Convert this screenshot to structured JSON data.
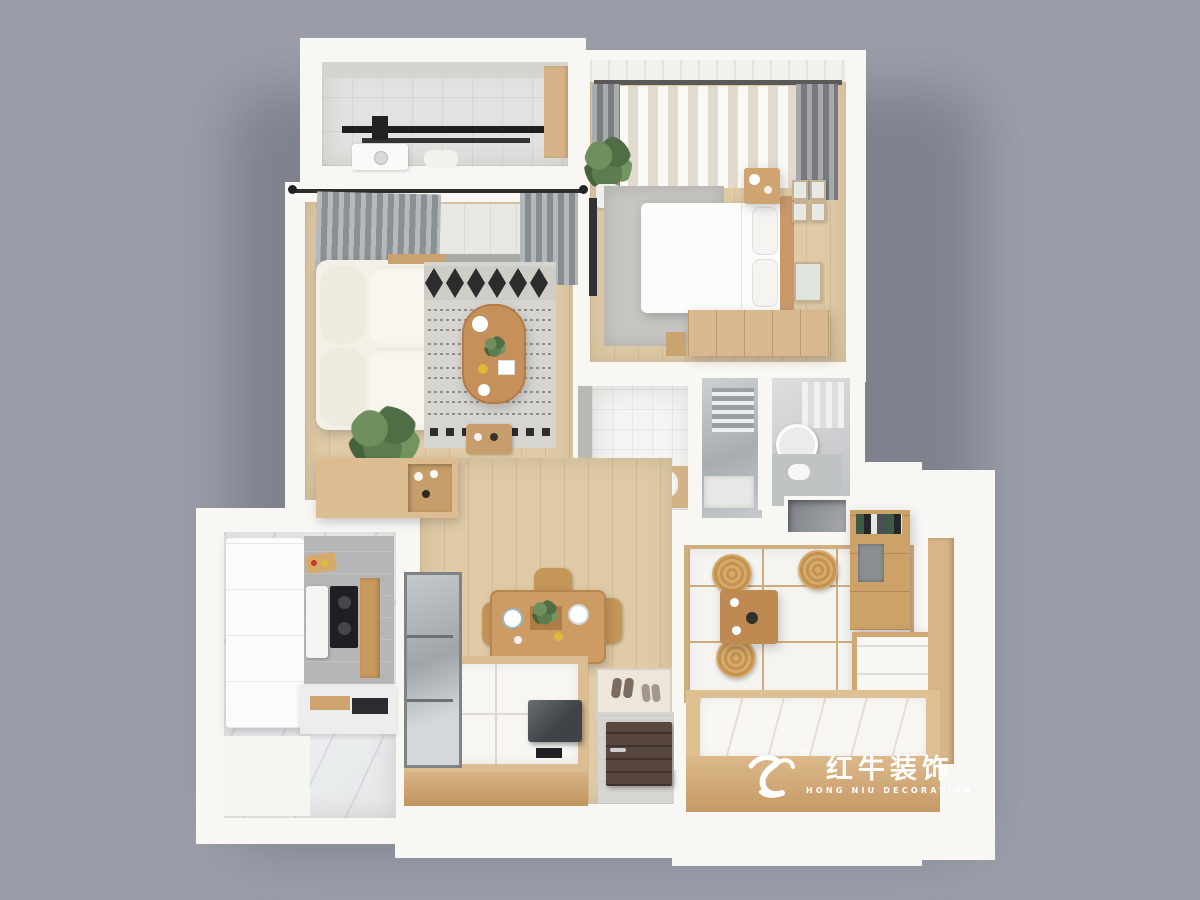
{
  "scene": {
    "type": "3d-floorplan-top-view-render",
    "background_color": "#9b9ea9",
    "palette": {
      "wall_white": "#f8f7f4",
      "wood_light": "#dcbc90",
      "wood_mid": "#c89b62",
      "floor_wood": "#e0cba6",
      "marble": "#eef0f1",
      "tile_gray": "#e2e3e0",
      "glass_gray": "#b9bec1",
      "door_dark": "#57473e",
      "accent_black": "#232323",
      "rattan": "#c2924f",
      "rug_gray": "#c8c6c1"
    },
    "rooms": [
      {
        "name": "balcony-laundry",
        "furniture": [
          "drying-rack",
          "washing-machine",
          "storage-cabinet"
        ]
      },
      {
        "name": "master-bedroom",
        "furniture": [
          "double-bed",
          "pillows",
          "headboard",
          "nightstand",
          "wardrobe",
          "rug",
          "sheer-curtain",
          "drape-curtains",
          "plant",
          "wall-frames",
          "wall-tv"
        ]
      },
      {
        "name": "living-room",
        "furniture": [
          "sofa",
          "coffee-table",
          "patterned-rug",
          "gray-curtains",
          "monstera-plant",
          "gallery-frames",
          "sideboard",
          "side-table"
        ]
      },
      {
        "name": "bathroom-suite",
        "furniture": [
          "bathtub",
          "shower-room",
          "towel-radiator",
          "round-mirror",
          "vanity-sink",
          "storage-niche"
        ]
      },
      {
        "name": "kitchen",
        "furniture": [
          "white-cabinets",
          "cooktop",
          "backsplash",
          "boiler",
          "tall-wood-cabinet",
          "counter",
          "cutting-board"
        ]
      },
      {
        "name": "dining-entry",
        "furniture": [
          "dining-table",
          "dining-chairs",
          "tableware",
          "glass-partition",
          "platform-bed",
          "lift-table",
          "doormat",
          "shoes",
          "entry-door"
        ]
      },
      {
        "name": "tatami-room",
        "furniture": [
          "tatami-platform",
          "floor-cushions",
          "tea-table",
          "desk-bookshelf",
          "drawer-cabinet",
          "tatami-bed"
        ]
      }
    ]
  },
  "watermark": {
    "registered": "®",
    "brand_cn": "红牛装饰",
    "brand_en": "HONG NIU DECORATION"
  }
}
